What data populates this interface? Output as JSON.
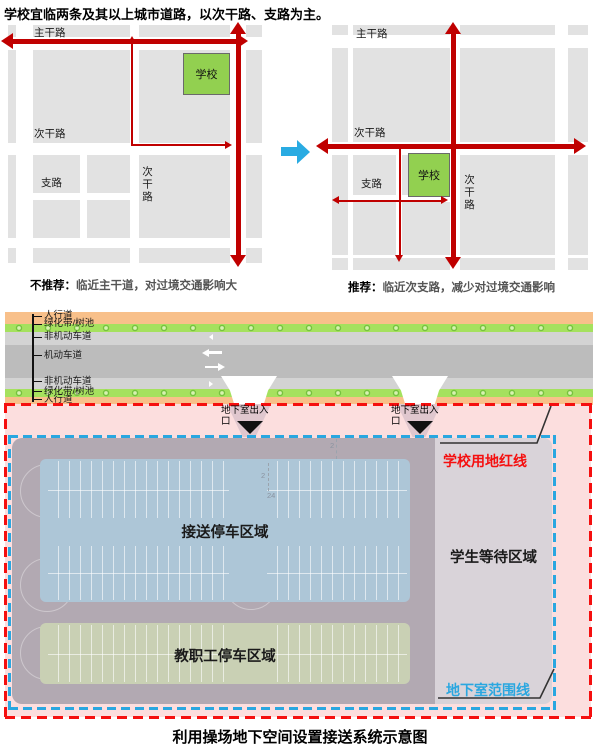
{
  "title": "学校宜临两条及其以上城市道路，以次干路、支路为主。",
  "figure1": {
    "left": {
      "main_road": "主干路",
      "secondary_road": "次干路",
      "branch_road": "支路",
      "secondary_road_vertical": "次干路",
      "school": "学校",
      "caption_tag": "不推荐：",
      "caption_text": "临近主干道，对过境交通影响大"
    },
    "right": {
      "main_road": "主干路",
      "secondary_road": "次干路",
      "branch_road": "支路",
      "secondary_road_vertical": "次干路",
      "school": "学校",
      "caption_tag": "推荐：",
      "caption_text": "临近次支路，减少对过境交通影响"
    }
  },
  "figure2": {
    "road_labels": [
      "人行道",
      "绿化带/树池",
      "非机动车道",
      "机动车道",
      "非机动车道",
      "绿化带/树池",
      "人行道"
    ],
    "entrance_label_line1": "地下室出入",
    "entrance_label_line2": "口",
    "red_line_label": "学校用地红线",
    "waiting_area_label": "学生等待区域",
    "pickup_area_label": "接送停车区域",
    "staff_area_label": "教职工停车区域",
    "basement_line_label": "地下室范围线",
    "cad_marks": [
      "2",
      "2",
      "24"
    ],
    "caption": "利用操场地下空间设置接送系统示意图"
  },
  "colors": {
    "red-arrow": "#c00000",
    "school-green": "#92d050",
    "block-gray": "#e2e2e2",
    "transform-blue": "#29abe2",
    "sidewalk-orange": "#f8c08a",
    "greenbelt-green": "#a5e15e",
    "nonmotor-gray": "#d3d3d3",
    "motor-gray": "#bcbcbc",
    "pink-zone": "#fcdede",
    "garage-mauve": "#b2a9b2",
    "waiting-gray": "#d9d3d9",
    "pickup-blue": "#adc6d7",
    "staff-green": "#c9d0b4",
    "ramp-pink": "#e0c7ce",
    "boundary-red": "#f50f0f",
    "boundary-blue": "#2aa7e0"
  }
}
